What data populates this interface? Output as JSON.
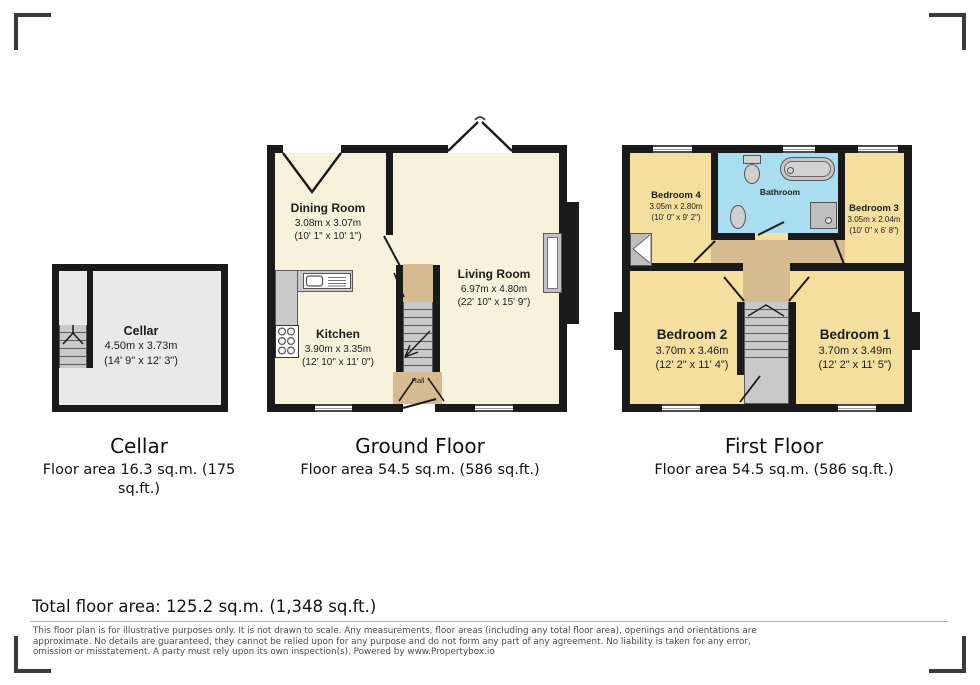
{
  "colors": {
    "wall": "#1a1a1a",
    "ground_floor_room": "#f8f2dd",
    "first_floor_room": "#f5df9e",
    "bathroom": "#a9def1",
    "hall_landing": "#d6bb90",
    "stairs_gray": "#c9c9c9",
    "cellar_room": "#e9e9e9"
  },
  "plans": {
    "cellar": {
      "room": {
        "name": "Cellar",
        "metric": "4.50m x 3.73m",
        "imperial": "(14' 9\" x 12' 3\")"
      },
      "caption_title": "Cellar",
      "caption_area_line1": "Floor area 16.3 sq.m. (175",
      "caption_area_line2": "sq.ft.)"
    },
    "ground_floor": {
      "caption_title": "Ground Floor",
      "caption_area": "Floor area 54.5 sq.m. (586 sq.ft.)",
      "dining": {
        "name": "Dining Room",
        "metric": "3.08m x 3.07m",
        "imperial": "(10' 1\" x 10' 1\")"
      },
      "kitchen": {
        "name": "Kitchen",
        "metric": "3.90m x 3.35m",
        "imperial": "(12' 10\" x 11' 0\")"
      },
      "living": {
        "name": "Living Room",
        "metric": "6.97m x 4.80m",
        "imperial": "(22' 10\" x 15' 9\")"
      },
      "hall": {
        "name": "Hall"
      }
    },
    "first_floor": {
      "caption_title": "First Floor",
      "caption_area": "Floor area 54.5 sq.m. (586 sq.ft.)",
      "bedroom4": {
        "name": "Bedroom 4",
        "metric": "3.05m x 2.80m",
        "imperial": "(10' 0\" x 9' 2\")"
      },
      "bathroom": {
        "name": "Bathroom"
      },
      "bedroom3": {
        "name": "Bedroom 3",
        "metric": "3.05m x 2.04m",
        "imperial": "(10' 0\" x 6' 8\")"
      },
      "bedroom2": {
        "name": "Bedroom 2",
        "metric": "3.70m x 3.46m",
        "imperial": "(12' 2\" x 11' 4\")"
      },
      "bedroom1": {
        "name": "Bedroom 1",
        "metric": "3.70m x 3.49m",
        "imperial": "(12' 2\" x 11' 5\")"
      }
    }
  },
  "summary": {
    "total_floor_area": "Total floor area: 125.2 sq.m. (1,348 sq.ft.)"
  },
  "disclaimer": {
    "line1": "This floor plan is for illustrative purposes only. It is not drawn to scale. Any measurements, floor areas (including any total floor area), openings and orientations are",
    "line2": "approximate. No details are guaranteed, they cannot be relied upon for any purpose and do not form any part of any agreement. No liability is taken for any error,",
    "line3": "omission or misstatement. A party must rely upon its own inspection(s). Powered by www.Propertybox.io"
  }
}
